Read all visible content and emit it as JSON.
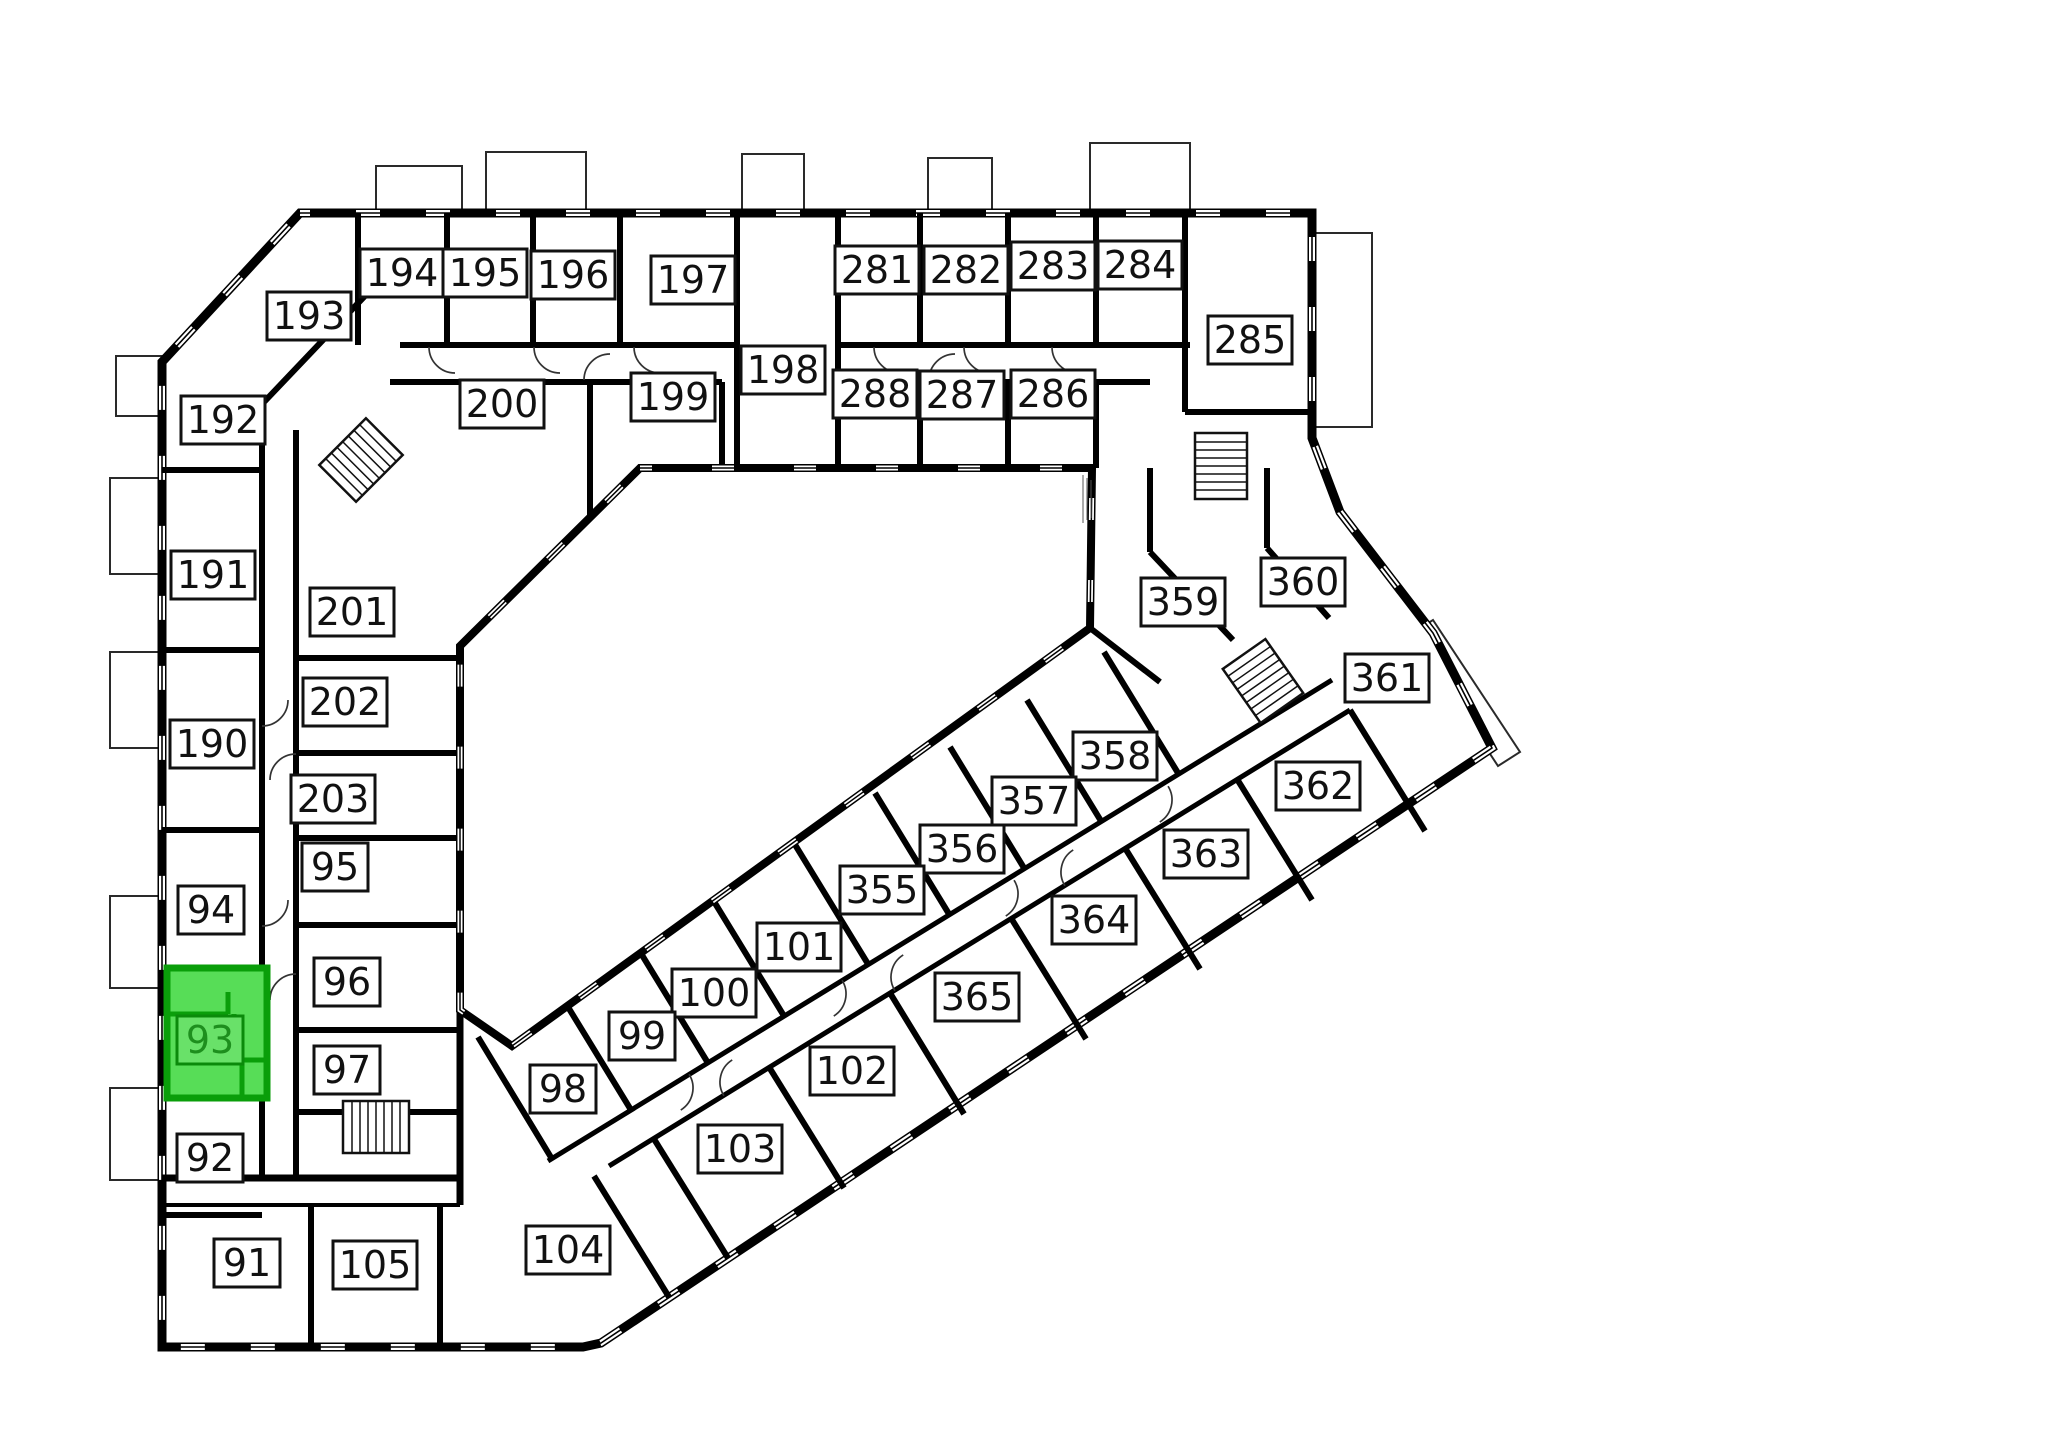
{
  "canvas": {
    "width": 2048,
    "height": 1447,
    "background": "#ffffff"
  },
  "colors": {
    "wall": "#000000",
    "background": "#ffffff",
    "label_fill": "#ffffff",
    "label_border": "#111111",
    "label_text": "#111111",
    "highlight_fill": "#57DD57",
    "highlight_wall": "#0A9E0A",
    "highlight_label_fill": "#69E169",
    "highlight_label_border": "#0B8A0B",
    "highlight_text": "#1E8F1E"
  },
  "selected_room": {
    "number": "93"
  },
  "rooms": [
    {
      "number": "192",
      "x": 223,
      "y": 420
    },
    {
      "number": "191",
      "x": 213,
      "y": 575
    },
    {
      "number": "190",
      "x": 212,
      "y": 744
    },
    {
      "number": "94",
      "x": 211,
      "y": 910
    },
    {
      "number": "93",
      "x": 210,
      "y": 1040,
      "highlighted": true
    },
    {
      "number": "92",
      "x": 210,
      "y": 1158
    },
    {
      "number": "91",
      "x": 247,
      "y": 1263
    },
    {
      "number": "105",
      "x": 375,
      "y": 1265
    },
    {
      "number": "104",
      "x": 568,
      "y": 1250
    },
    {
      "number": "201",
      "x": 352,
      "y": 612
    },
    {
      "number": "202",
      "x": 345,
      "y": 702
    },
    {
      "number": "203",
      "x": 333,
      "y": 799
    },
    {
      "number": "95",
      "x": 335,
      "y": 867
    },
    {
      "number": "96",
      "x": 347,
      "y": 982
    },
    {
      "number": "97",
      "x": 347,
      "y": 1070
    },
    {
      "number": "193",
      "x": 309,
      "y": 316
    },
    {
      "number": "194",
      "x": 402,
      "y": 273
    },
    {
      "number": "195",
      "x": 485,
      "y": 273
    },
    {
      "number": "196",
      "x": 573,
      "y": 275
    },
    {
      "number": "197",
      "x": 693,
      "y": 280
    },
    {
      "number": "200",
      "x": 502,
      "y": 404
    },
    {
      "number": "199",
      "x": 673,
      "y": 397
    },
    {
      "number": "198",
      "x": 783,
      "y": 370
    },
    {
      "number": "281",
      "x": 877,
      "y": 270
    },
    {
      "number": "282",
      "x": 966,
      "y": 270
    },
    {
      "number": "283",
      "x": 1053,
      "y": 266
    },
    {
      "number": "284",
      "x": 1140,
      "y": 265
    },
    {
      "number": "285",
      "x": 1250,
      "y": 340
    },
    {
      "number": "288",
      "x": 875,
      "y": 394
    },
    {
      "number": "287",
      "x": 962,
      "y": 395
    },
    {
      "number": "286",
      "x": 1053,
      "y": 394
    },
    {
      "number": "359",
      "x": 1183,
      "y": 602
    },
    {
      "number": "360",
      "x": 1303,
      "y": 582
    },
    {
      "number": "361",
      "x": 1387,
      "y": 678
    },
    {
      "number": "362",
      "x": 1318,
      "y": 786
    },
    {
      "number": "363",
      "x": 1206,
      "y": 854
    },
    {
      "number": "364",
      "x": 1094,
      "y": 920
    },
    {
      "number": "365",
      "x": 977,
      "y": 997
    },
    {
      "number": "358",
      "x": 1115,
      "y": 756
    },
    {
      "number": "357",
      "x": 1034,
      "y": 801
    },
    {
      "number": "356",
      "x": 962,
      "y": 849
    },
    {
      "number": "355",
      "x": 882,
      "y": 890
    },
    {
      "number": "101",
      "x": 799,
      "y": 947
    },
    {
      "number": "100",
      "x": 714,
      "y": 993
    },
    {
      "number": "99",
      "x": 642,
      "y": 1036
    },
    {
      "number": "98",
      "x": 563,
      "y": 1089
    },
    {
      "number": "102",
      "x": 852,
      "y": 1071
    },
    {
      "number": "103",
      "x": 740,
      "y": 1149
    }
  ]
}
